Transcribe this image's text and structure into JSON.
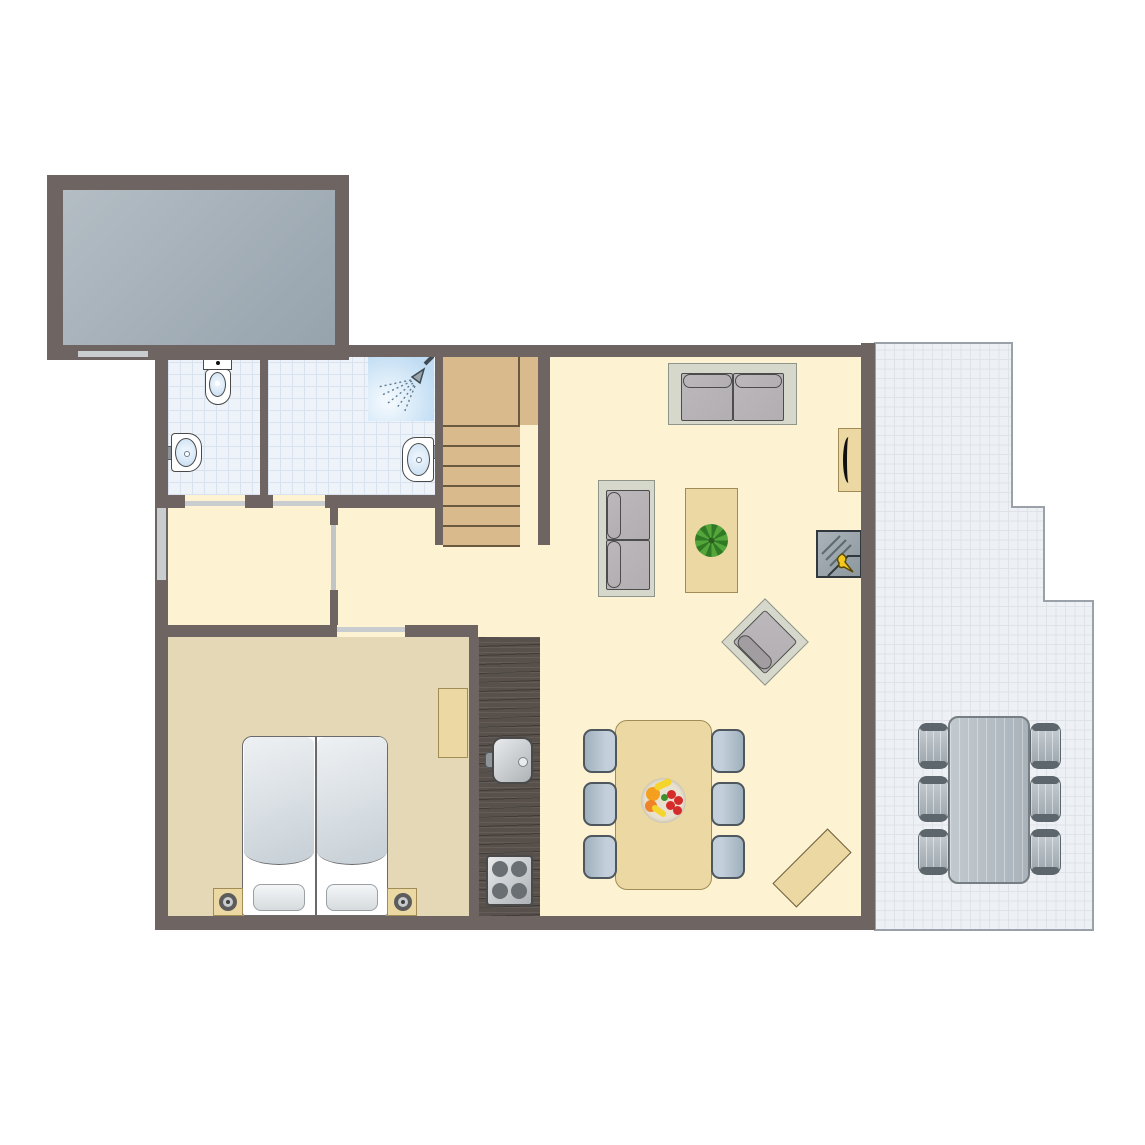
{
  "floorplan": {
    "type": "apartment-ground-floor",
    "colors": {
      "wall": "#6e6461",
      "floor_cream": "#fdf2d2",
      "floor_bedroom": "#e4d8b6",
      "floor_bathroom": "#eef2f9",
      "bathroom_grid": "#d9e3f0",
      "carport_a": "#b4bdc4",
      "carport_b": "#96a3ad",
      "terrace_floor": "#edf0f4",
      "terrace_grid": "#c6ccd4",
      "terrace_grid_light": "#dfe3e8",
      "terrace_outline": "#9aa1a8",
      "wood_light": "#ecd8a2",
      "wood_border": "#a08c54",
      "wood_stairs": "#d9ba8c",
      "stairs_line": "#6b5a3f",
      "counter_dark": "#57504b",
      "door_mark": "#c9cdd0",
      "sofa_frame": "#d6d8cb",
      "sofa_frame_border": "#90958b",
      "cushion": "#b2aeb1",
      "cushion_border": "#4c4c4c",
      "chair_blue_a": "#c3cfda",
      "chair_blue_b": "#9fb0bd",
      "chair_border": "#4e565e",
      "outdoor_a": "#c9d0d5",
      "outdoor_b": "#9aa4ab",
      "outdoor_dark": "#5d666d",
      "table_gray_a": "#c2cad0",
      "table_gray_b": "#a9b2b9",
      "table_gray_border": "#767d83",
      "fixture_blue": "#c3dcf2",
      "fixture_border": "#4a4a4a",
      "shower_blue": "#bfdcf3",
      "tap_gray": "#8f969b",
      "metal_a": "#e8eaec",
      "metal_b": "#aeb3b6",
      "burner": "#6a6f73",
      "fireplace_a": "#aab3ba",
      "fireplace_b": "#8d979e",
      "flame": "#f5c81e",
      "plant_a": "#54a53c",
      "plant_b": "#2f7a22",
      "bowl": "#e9e1cf",
      "fruit_orange": "#f59f1e",
      "fruit_orange2": "#ef8329",
      "fruit_red": "#d62b2b",
      "fruit_yellow": "#f5d42c",
      "fruit_green": "#3f8f2f",
      "lamp_ring": "#5c5c5c"
    },
    "rooms": [
      {
        "id": "carport",
        "floor": "concrete-gray"
      },
      {
        "id": "bathroom-small",
        "floor": "blue-tile",
        "fixtures": [
          "toilet",
          "washbasin"
        ]
      },
      {
        "id": "bathroom-large",
        "floor": "blue-tile",
        "fixtures": [
          "shower",
          "washbasin"
        ]
      },
      {
        "id": "hallway",
        "floor": "cream"
      },
      {
        "id": "staircase",
        "steps": 6,
        "material": "wood"
      },
      {
        "id": "bedroom",
        "floor": "tan",
        "furniture": [
          "double-bed",
          "nightstand-left",
          "nightstand-right",
          "desk"
        ]
      },
      {
        "id": "kitchen",
        "furniture": [
          "counter",
          "sink",
          "stove-4-burner"
        ]
      },
      {
        "id": "living-room",
        "floor": "cream",
        "furniture": [
          "sofa-large",
          "sofa-small",
          "coffee-table",
          "plant",
          "armchair",
          "tv-cabinet",
          "tv",
          "fireplace"
        ]
      },
      {
        "id": "dining-area",
        "floor": "cream",
        "furniture": [
          "dining-table",
          "dining-chairs-x6",
          "fruit-bowl",
          "bench"
        ]
      },
      {
        "id": "terrace",
        "floor": "white-tile",
        "furniture": [
          "outdoor-table",
          "outdoor-chairs-x6"
        ]
      }
    ],
    "door_marks": [
      "carport-door",
      "entry-door",
      "bathroom-small-door",
      "bathroom-large-door",
      "hall-door",
      "bedroom-sliding-door"
    ]
  }
}
